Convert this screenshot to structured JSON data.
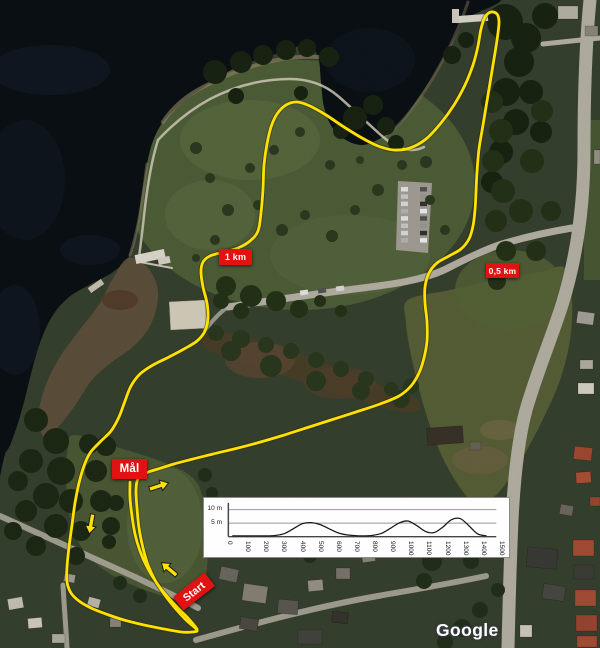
{
  "map": {
    "provider_watermark": "Google",
    "markers": [
      {
        "id": "distance-1km",
        "label": "1 km"
      },
      {
        "id": "distance-0-5km",
        "label": "0,5 km"
      },
      {
        "id": "finish",
        "label": "Mål"
      },
      {
        "id": "start",
        "label": "Start"
      }
    ],
    "direction_arrows": [
      {
        "location": "finish-chute",
        "direction": "up-right"
      },
      {
        "location": "west-shore-leg",
        "direction": "down"
      },
      {
        "location": "start-stretch",
        "direction": "up-left"
      }
    ],
    "colors": {
      "route": "#ffe103",
      "marker_background": "#e11212",
      "marker_text": "#ffffff",
      "arrow": "#ffe103",
      "water": "#0b1016"
    }
  },
  "chart_data": {
    "type": "line",
    "title": "Course elevation profile",
    "xlabel": "",
    "ylabel": "",
    "xlim": [
      0,
      1500
    ],
    "ylim": [
      0,
      12
    ],
    "grid": true,
    "legend": "none",
    "yticks": [
      {
        "label": "10 m",
        "value": 10
      },
      {
        "label": "5 m",
        "value": 5
      }
    ],
    "xticks": [
      0,
      100,
      200,
      300,
      400,
      500,
      600,
      700,
      800,
      900,
      1000,
      1100,
      1200,
      1300,
      1400,
      1500
    ],
    "x_m": [
      0,
      50,
      100,
      150,
      200,
      250,
      300,
      350,
      400,
      450,
      500,
      550,
      600,
      650,
      700,
      750,
      800,
      850,
      900,
      950,
      1000,
      1050,
      1100,
      1150,
      1200,
      1250,
      1300,
      1350,
      1400,
      1450
    ],
    "elevation_m": [
      0.3,
      0.3,
      0.3,
      0.3,
      0.3,
      0.5,
      1.2,
      3.0,
      4.8,
      5.2,
      4.5,
      3.0,
      1.5,
      0.7,
      0.4,
      0.3,
      0.5,
      1.2,
      3.0,
      5.0,
      5.8,
      4.2,
      2.0,
      1.5,
      3.5,
      6.3,
      6.7,
      4.0,
      1.0,
      0.3
    ]
  }
}
